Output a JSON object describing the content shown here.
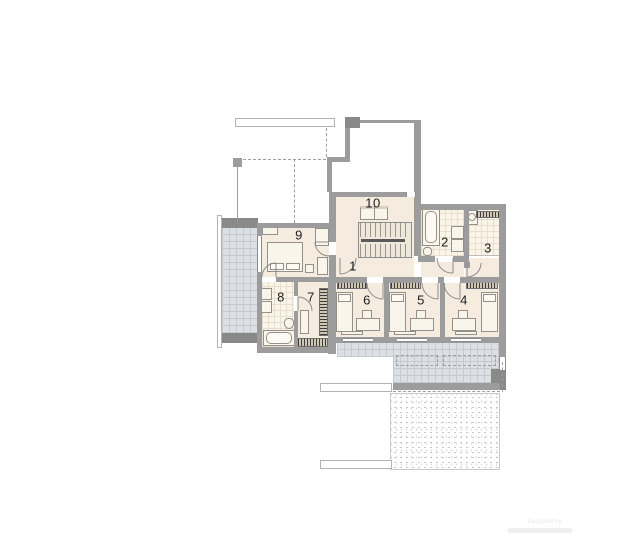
{
  "rooms": [
    {
      "id": "room-1",
      "label": "1"
    },
    {
      "id": "room-2",
      "label": "2"
    },
    {
      "id": "room-3",
      "label": "3"
    },
    {
      "id": "room-4",
      "label": "4"
    },
    {
      "id": "room-5",
      "label": "5"
    },
    {
      "id": "room-6",
      "label": "6"
    },
    {
      "id": "room-7",
      "label": "7"
    },
    {
      "id": "room-8",
      "label": "8"
    },
    {
      "id": "room-9",
      "label": "9"
    },
    {
      "id": "room-10",
      "label": "10"
    }
  ],
  "watermark": {
    "line1": "Designed by"
  },
  "colors": {
    "background": "#ffffff",
    "wall": "#9c9c9c",
    "floor_beige": "#f5ecdf",
    "terrace_tile": "#dcdfe4",
    "bath_tile": "#faf4e9",
    "hatch_dark": "#3d3d3d",
    "stipple_dot": "#c6c6c6",
    "label_text": "#1d1d1d"
  }
}
